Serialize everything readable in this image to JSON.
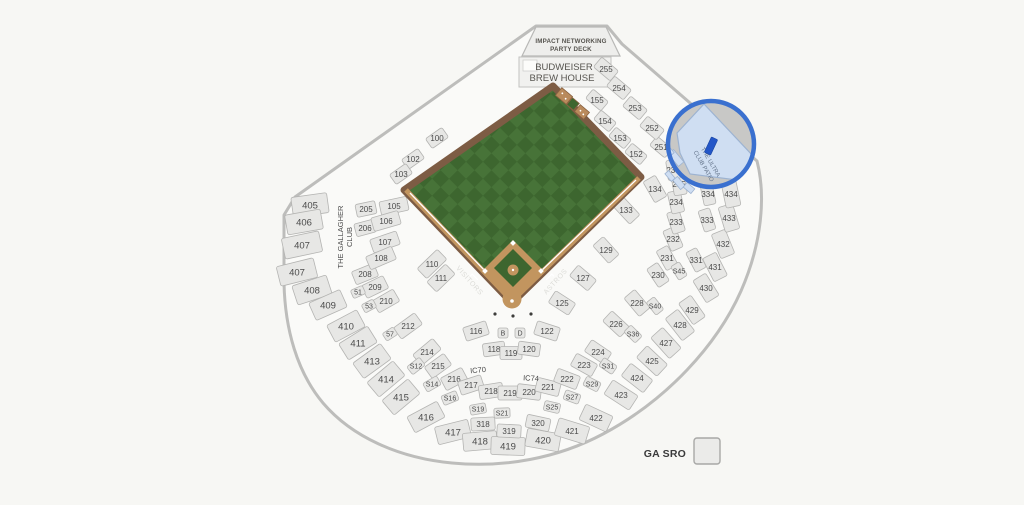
{
  "map_title": "Minute Maid Park seating map",
  "team_home": "ASTROS",
  "team_visitor": "VISITORS",
  "labels": {
    "party_deck_line1": "IMPACT NETWORKING",
    "party_deck_line2": "PARTY DECK",
    "brew_house_line1": "BUDWEISER",
    "brew_house_line2": "BREW HOUSE",
    "gallagher_line1": "THE GALLAGHER",
    "gallagher_line2": "CLUB",
    "ultra_line1": "THE ULTRA",
    "ultra_line2": "CLUB PATIO",
    "visitors": "VISITORS",
    "astros": "ASTROS"
  },
  "legend": {
    "ga_sro": "GA SRO"
  },
  "colors": {
    "background": "#f7f7f4",
    "bowl_fill": "#fafaf8",
    "bowl_stroke": "#bdbdbb",
    "section_fill": "#e7e7e5",
    "section_stroke": "#b4b4b2",
    "label": "#4a4a4a",
    "turf_dark": "#3d662f",
    "turf_light": "#477338",
    "wall_brown": "#7d5c44",
    "dirt_tan": "#c2955f",
    "highlight_ring": "#3a70cf",
    "highlight_gray": "#c8c8c6",
    "highlight_section": "#cfdef2",
    "marker_blue": "#2356c8"
  },
  "highlight": {
    "section_name": "THE ULTRA CLUB PATIO",
    "ring": "#3a70cf",
    "marker_color": "#2356c8"
  },
  "ic_labels": [
    {
      "l": "IC70",
      "x": 478,
      "y": 370,
      "r": -5
    },
    {
      "l": "IC74",
      "x": 531,
      "y": 378,
      "r": 3
    }
  ],
  "sections": [
    {
      "l": "405",
      "x": 310,
      "y": 205,
      "r": -8,
      "w": 36,
      "h": 20
    },
    {
      "l": "406",
      "x": 304,
      "y": 222,
      "r": -10,
      "w": 36,
      "h": 20
    },
    {
      "l": "407",
      "x": 302,
      "y": 245,
      "r": -12,
      "w": 38,
      "h": 21
    },
    {
      "l": "407",
      "x": 297,
      "y": 272,
      "r": -14,
      "w": 38,
      "h": 20
    },
    {
      "l": "408",
      "x": 312,
      "y": 290,
      "r": -18,
      "w": 36,
      "h": 20
    },
    {
      "l": "409",
      "x": 328,
      "y": 305,
      "r": -24,
      "w": 34,
      "h": 19
    },
    {
      "l": "410",
      "x": 346,
      "y": 326,
      "r": -28,
      "w": 34,
      "h": 19
    },
    {
      "l": "411",
      "x": 358,
      "y": 343,
      "r": -32,
      "w": 34,
      "h": 19
    },
    {
      "l": "413",
      "x": 372,
      "y": 361,
      "r": -36,
      "w": 34,
      "h": 19
    },
    {
      "l": "414",
      "x": 386,
      "y": 379,
      "r": -40,
      "w": 34,
      "h": 19
    },
    {
      "l": "415",
      "x": 401,
      "y": 397,
      "r": -40,
      "w": 34,
      "h": 19
    },
    {
      "l": "416",
      "x": 426,
      "y": 417,
      "r": -28,
      "w": 34,
      "h": 18
    },
    {
      "l": "417",
      "x": 453,
      "y": 432,
      "r": -14,
      "w": 34,
      "h": 18
    },
    {
      "l": "418",
      "x": 480,
      "y": 441,
      "r": -5,
      "w": 34,
      "h": 18
    },
    {
      "l": "419",
      "x": 508,
      "y": 446,
      "r": 2,
      "w": 34,
      "h": 18
    },
    {
      "l": "420",
      "x": 543,
      "y": 440,
      "r": 10,
      "w": 34,
      "h": 18
    },
    {
      "l": "421",
      "x": 572,
      "y": 431,
      "r": 17,
      "w": 32,
      "h": 18
    },
    {
      "l": "422",
      "x": 596,
      "y": 418,
      "r": 25,
      "w": 30,
      "h": 17
    },
    {
      "l": "423",
      "x": 621,
      "y": 395,
      "r": 33,
      "w": 30,
      "h": 17
    },
    {
      "l": "424",
      "x": 637,
      "y": 378,
      "r": 38,
      "w": 28,
      "h": 16
    },
    {
      "l": "425",
      "x": 652,
      "y": 361,
      "r": 43,
      "w": 28,
      "h": 16
    },
    {
      "l": "427",
      "x": 666,
      "y": 343,
      "r": 48,
      "w": 28,
      "h": 16
    },
    {
      "l": "428",
      "x": 680,
      "y": 325,
      "r": 52,
      "w": 28,
      "h": 16
    },
    {
      "l": "429",
      "x": 692,
      "y": 310,
      "r": 55,
      "w": 26,
      "h": 15
    },
    {
      "l": "430",
      "x": 706,
      "y": 288,
      "r": 58,
      "w": 26,
      "h": 15
    },
    {
      "l": "431",
      "x": 715,
      "y": 267,
      "r": 63,
      "w": 26,
      "h": 15
    },
    {
      "l": "432",
      "x": 723,
      "y": 244,
      "r": 68,
      "w": 26,
      "h": 15
    },
    {
      "l": "433",
      "x": 729,
      "y": 218,
      "r": 73,
      "w": 26,
      "h": 15
    },
    {
      "l": "434",
      "x": 731,
      "y": 194,
      "r": 78,
      "w": 26,
      "h": 15
    },
    {
      "l": "205",
      "x": 366,
      "y": 209,
      "r": -12,
      "w": 20,
      "h": 13
    },
    {
      "l": "206",
      "x": 365,
      "y": 228,
      "r": -15,
      "w": 20,
      "h": 13
    },
    {
      "l": "208",
      "x": 365,
      "y": 274,
      "r": -22,
      "w": 24,
      "h": 14
    },
    {
      "l": "209",
      "x": 375,
      "y": 287,
      "r": -26,
      "w": 24,
      "h": 14
    },
    {
      "l": "210",
      "x": 386,
      "y": 301,
      "r": -30,
      "w": 24,
      "h": 14
    },
    {
      "l": "212",
      "x": 408,
      "y": 326,
      "r": -36,
      "w": 26,
      "h": 14
    },
    {
      "l": "214",
      "x": 427,
      "y": 352,
      "r": -40,
      "w": 26,
      "h": 14
    },
    {
      "l": "215",
      "x": 438,
      "y": 366,
      "r": -36,
      "w": 24,
      "h": 14
    },
    {
      "l": "216",
      "x": 454,
      "y": 379,
      "r": -28,
      "w": 24,
      "h": 14
    },
    {
      "l": "217",
      "x": 471,
      "y": 385,
      "r": -18,
      "w": 24,
      "h": 14
    },
    {
      "l": "218",
      "x": 491,
      "y": 391,
      "r": -9,
      "w": 24,
      "h": 14
    },
    {
      "l": "219",
      "x": 510,
      "y": 393,
      "r": 0,
      "w": 24,
      "h": 14
    },
    {
      "l": "220",
      "x": 529,
      "y": 392,
      "r": 7,
      "w": 24,
      "h": 14
    },
    {
      "l": "221",
      "x": 548,
      "y": 387,
      "r": 14,
      "w": 24,
      "h": 14
    },
    {
      "l": "222",
      "x": 567,
      "y": 379,
      "r": 21,
      "w": 24,
      "h": 14
    },
    {
      "l": "223",
      "x": 584,
      "y": 365,
      "r": 29,
      "w": 24,
      "h": 14
    },
    {
      "l": "224",
      "x": 598,
      "y": 352,
      "r": 34,
      "w": 24,
      "h": 14
    },
    {
      "l": "226",
      "x": 616,
      "y": 324,
      "r": 43,
      "w": 24,
      "h": 14
    },
    {
      "l": "228",
      "x": 637,
      "y": 303,
      "r": 50,
      "w": 24,
      "h": 14
    },
    {
      "l": "230",
      "x": 658,
      "y": 275,
      "r": 56,
      "w": 22,
      "h": 13
    },
    {
      "l": "231",
      "x": 667,
      "y": 258,
      "r": 61,
      "w": 22,
      "h": 13
    },
    {
      "l": "232",
      "x": 673,
      "y": 239,
      "r": 66,
      "w": 22,
      "h": 13
    },
    {
      "l": "233",
      "x": 676,
      "y": 222,
      "r": 72,
      "w": 22,
      "h": 13
    },
    {
      "l": "234",
      "x": 676,
      "y": 202,
      "r": 77,
      "w": 22,
      "h": 13
    },
    {
      "l": "235",
      "x": 679,
      "y": 184,
      "r": 80,
      "w": 22,
      "h": 13
    },
    {
      "l": "236",
      "x": 673,
      "y": 170,
      "r": 82,
      "w": 20,
      "h": 12
    },
    {
      "l": "251",
      "x": 661,
      "y": 147,
      "r": 40,
      "w": 20,
      "h": 12
    },
    {
      "l": "252",
      "x": 652,
      "y": 128,
      "r": 40,
      "w": 22,
      "h": 13
    },
    {
      "l": "253",
      "x": 635,
      "y": 108,
      "r": 40,
      "w": 22,
      "h": 13
    },
    {
      "l": "254",
      "x": 619,
      "y": 88,
      "r": 40,
      "w": 22,
      "h": 13
    },
    {
      "l": "255",
      "x": 606,
      "y": 69,
      "r": 40,
      "w": 22,
      "h": 13
    },
    {
      "l": "152",
      "x": 636,
      "y": 154,
      "r": 40,
      "w": 20,
      "h": 12
    },
    {
      "l": "153",
      "x": 620,
      "y": 138,
      "r": 40,
      "w": 20,
      "h": 12
    },
    {
      "l": "154",
      "x": 605,
      "y": 121,
      "r": 40,
      "w": 20,
      "h": 12
    },
    {
      "l": "155",
      "x": 597,
      "y": 100,
      "r": 40,
      "w": 20,
      "h": 12
    },
    {
      "l": "100",
      "x": 437,
      "y": 138,
      "r": -35,
      "w": 20,
      "h": 12
    },
    {
      "l": "102",
      "x": 413,
      "y": 159,
      "r": -35,
      "w": 20,
      "h": 12
    },
    {
      "l": "103",
      "x": 401,
      "y": 174,
      "r": -35,
      "w": 20,
      "h": 12
    },
    {
      "l": "105",
      "x": 394,
      "y": 206,
      "r": -12,
      "w": 28,
      "h": 14
    },
    {
      "l": "106",
      "x": 386,
      "y": 221,
      "r": -16,
      "w": 28,
      "h": 14
    },
    {
      "l": "107",
      "x": 385,
      "y": 242,
      "r": -19,
      "w": 28,
      "h": 14
    },
    {
      "l": "108",
      "x": 381,
      "y": 258,
      "r": -23,
      "w": 28,
      "h": 14
    },
    {
      "l": "110",
      "x": 432,
      "y": 264,
      "r": -44,
      "w": 28,
      "h": 14
    },
    {
      "l": "111",
      "x": 441,
      "y": 278,
      "r": -44,
      "w": 26,
      "h": 14
    },
    {
      "l": "116",
      "x": 476,
      "y": 331,
      "r": -18,
      "w": 24,
      "h": 14
    },
    {
      "l": "118",
      "x": 494,
      "y": 349,
      "r": -8,
      "w": 22,
      "h": 13
    },
    {
      "l": "119",
      "x": 511,
      "y": 353,
      "r": 0,
      "w": 22,
      "h": 13
    },
    {
      "l": "120",
      "x": 529,
      "y": 349,
      "r": 8,
      "w": 22,
      "h": 13
    },
    {
      "l": "122",
      "x": 547,
      "y": 331,
      "r": 18,
      "w": 24,
      "h": 14
    },
    {
      "l": "125",
      "x": 562,
      "y": 303,
      "r": 33,
      "w": 24,
      "h": 14
    },
    {
      "l": "127",
      "x": 583,
      "y": 278,
      "r": 40,
      "w": 24,
      "h": 14
    },
    {
      "l": "129",
      "x": 606,
      "y": 250,
      "r": 48,
      "w": 24,
      "h": 14
    },
    {
      "l": "133",
      "x": 626,
      "y": 210,
      "r": 47,
      "w": 26,
      "h": 14
    },
    {
      "l": "134",
      "x": 655,
      "y": 189,
      "r": 60,
      "w": 24,
      "h": 14
    },
    {
      "l": "318",
      "x": 483,
      "y": 424,
      "r": -3,
      "w": 24,
      "h": 13
    },
    {
      "l": "319",
      "x": 509,
      "y": 431,
      "r": 3,
      "w": 24,
      "h": 13
    },
    {
      "l": "320",
      "x": 538,
      "y": 423,
      "r": 12,
      "w": 24,
      "h": 13
    },
    {
      "l": "331",
      "x": 696,
      "y": 260,
      "r": 62,
      "w": 22,
      "h": 12
    },
    {
      "l": "333",
      "x": 707,
      "y": 220,
      "r": 72,
      "w": 22,
      "h": 12
    },
    {
      "l": "334",
      "x": 708,
      "y": 194,
      "r": 78,
      "w": 22,
      "h": 12
    },
    {
      "l": "S12",
      "x": 416,
      "y": 366,
      "r": -38,
      "w": 16,
      "h": 10
    },
    {
      "l": "S14",
      "x": 432,
      "y": 384,
      "r": -30,
      "w": 16,
      "h": 10
    },
    {
      "l": "S16",
      "x": 450,
      "y": 398,
      "r": -22,
      "w": 16,
      "h": 10
    },
    {
      "l": "S19",
      "x": 478,
      "y": 409,
      "r": -10,
      "w": 16,
      "h": 10
    },
    {
      "l": "S21",
      "x": 502,
      "y": 413,
      "r": -2,
      "w": 16,
      "h": 10
    },
    {
      "l": "S25",
      "x": 552,
      "y": 407,
      "r": 13,
      "w": 16,
      "h": 10
    },
    {
      "l": "S27",
      "x": 572,
      "y": 397,
      "r": 20,
      "w": 16,
      "h": 10
    },
    {
      "l": "S29",
      "x": 592,
      "y": 384,
      "r": 27,
      "w": 16,
      "h": 10
    },
    {
      "l": "S31",
      "x": 608,
      "y": 366,
      "r": 34,
      "w": 16,
      "h": 10
    },
    {
      "l": "S36",
      "x": 633,
      "y": 334,
      "r": 45,
      "w": 16,
      "h": 10
    },
    {
      "l": "S40",
      "x": 655,
      "y": 306,
      "r": 52,
      "w": 16,
      "h": 10
    },
    {
      "l": "S45",
      "x": 679,
      "y": 271,
      "r": 58,
      "w": 16,
      "h": 10
    },
    {
      "l": "51",
      "x": 358,
      "y": 292,
      "r": -24,
      "w": 13,
      "h": 9
    },
    {
      "l": "53",
      "x": 369,
      "y": 306,
      "r": -28,
      "w": 13,
      "h": 9
    },
    {
      "l": "57",
      "x": 390,
      "y": 334,
      "r": -33,
      "w": 13,
      "h": 9
    },
    {
      "l": "B",
      "x": 503,
      "y": 333,
      "r": 0,
      "w": 10,
      "h": 10
    },
    {
      "l": "D",
      "x": 520,
      "y": 333,
      "r": 0,
      "w": 10,
      "h": 10
    }
  ]
}
